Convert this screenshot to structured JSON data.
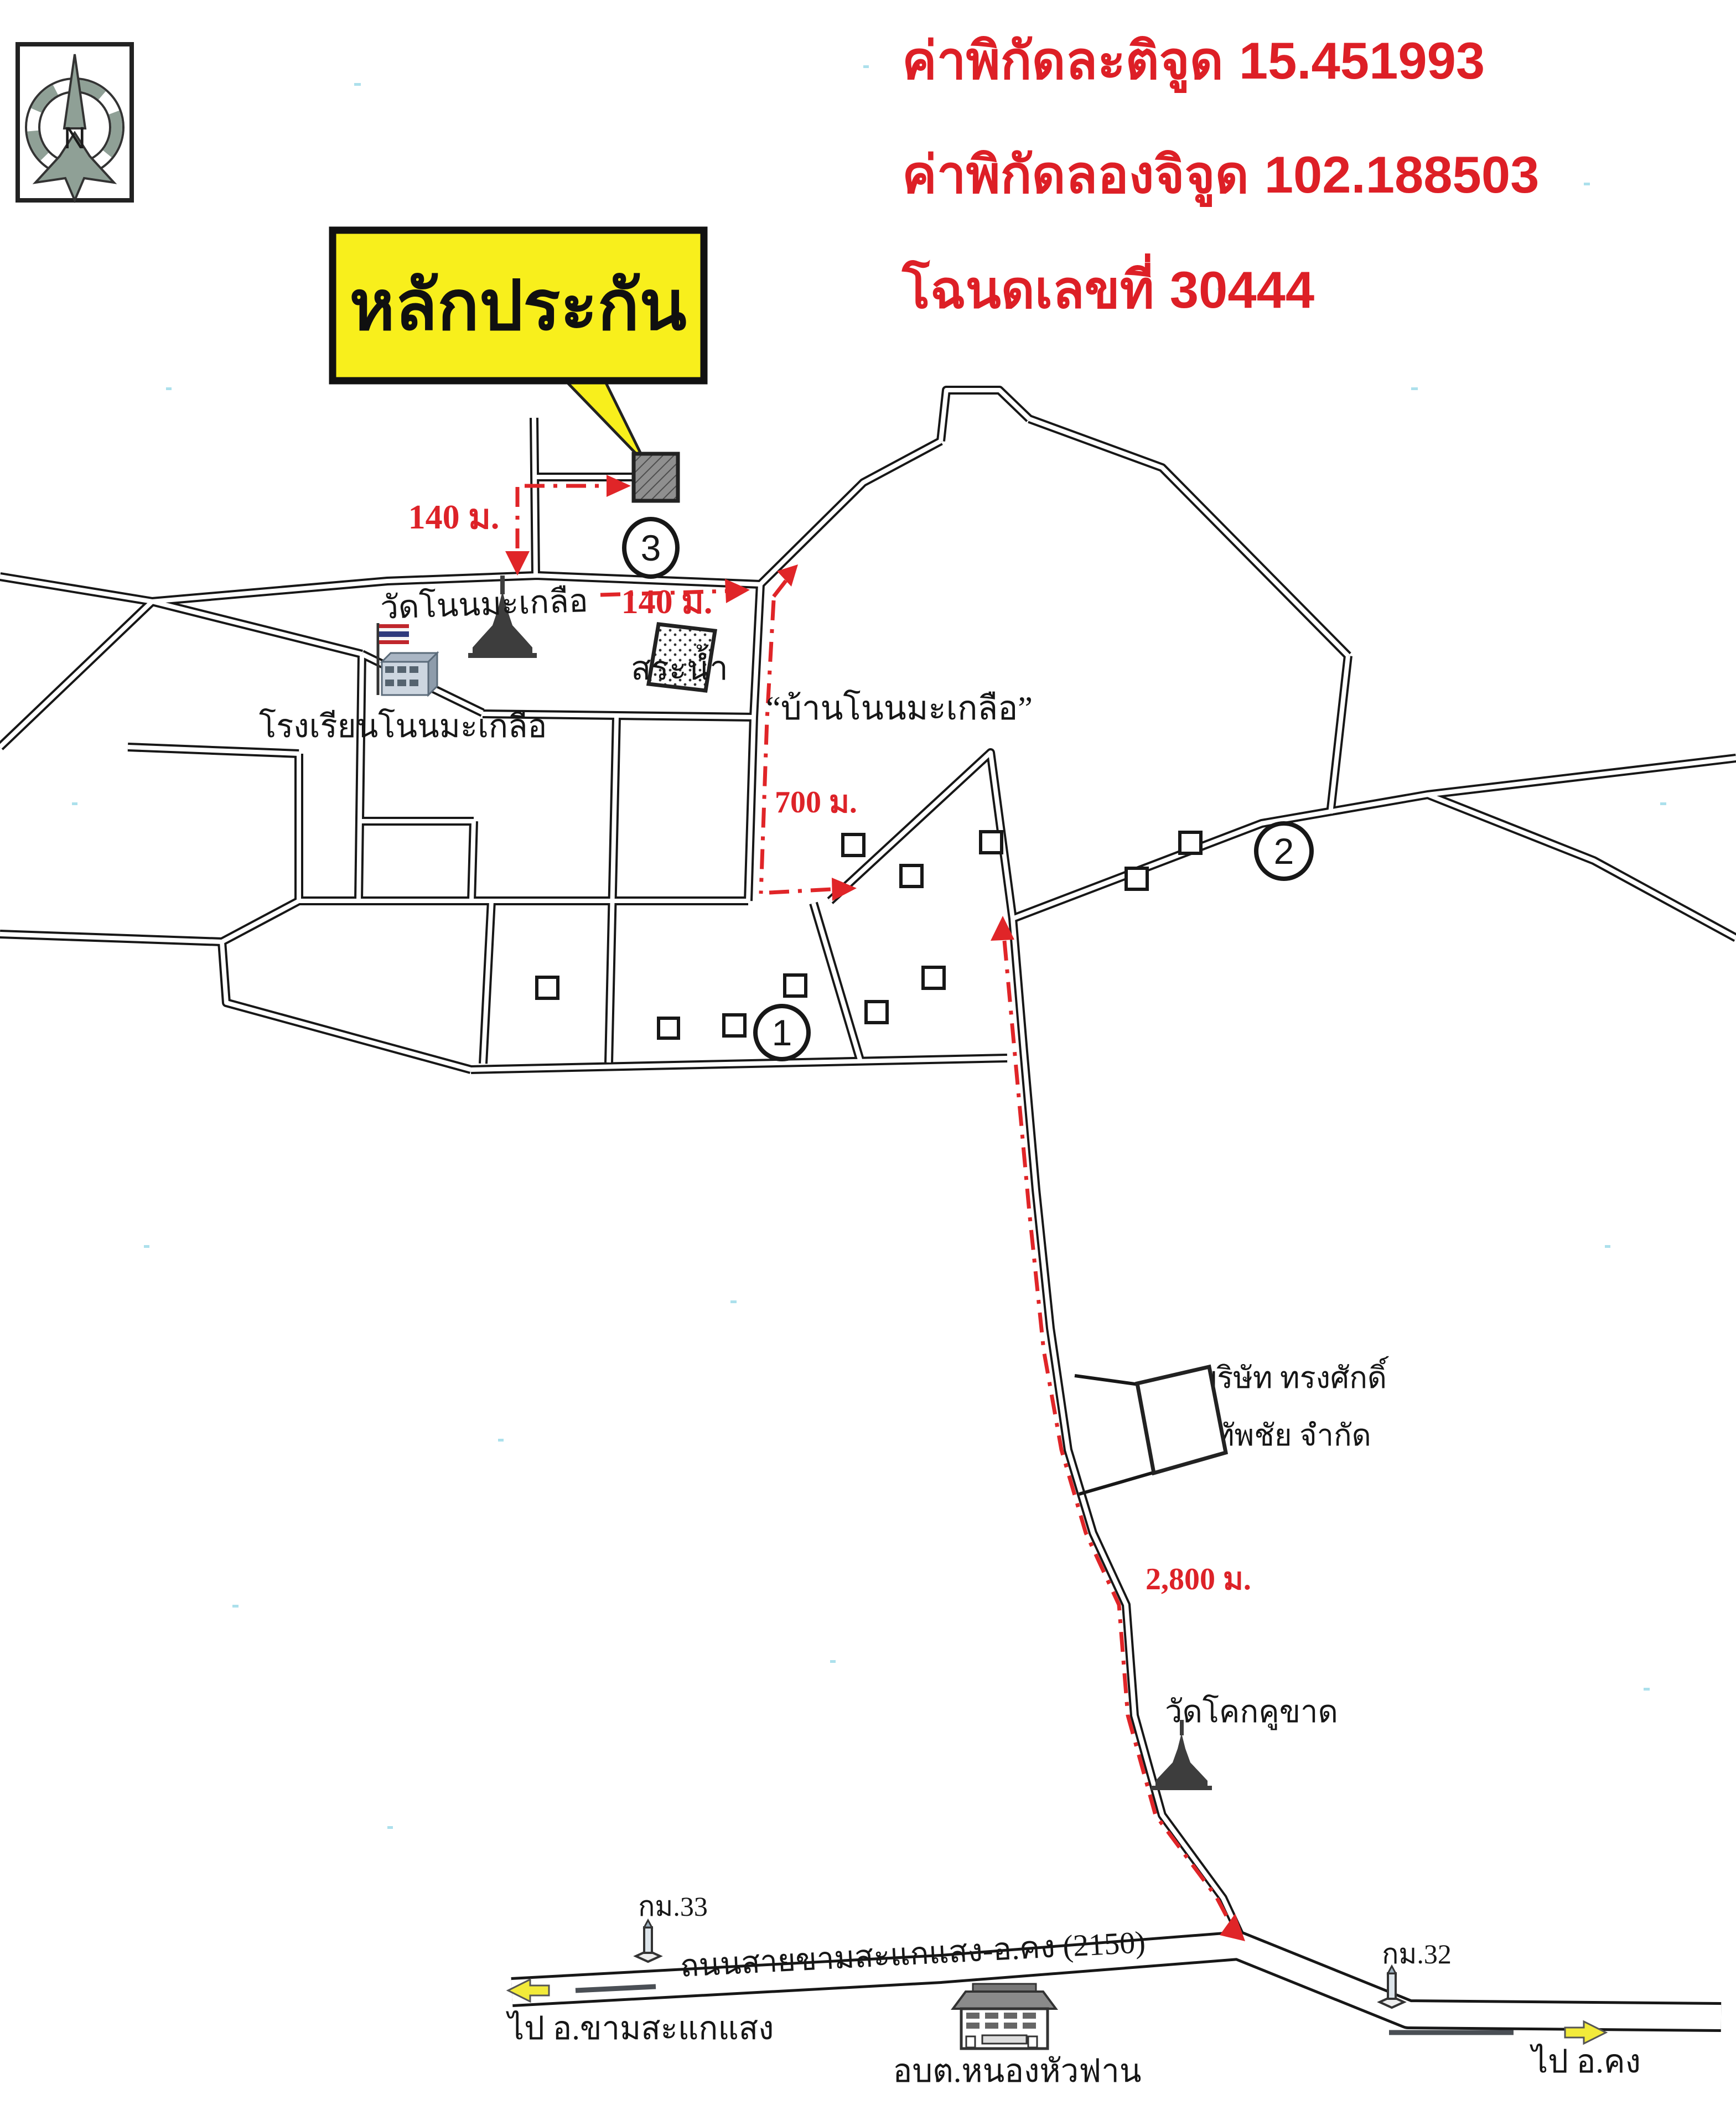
{
  "colors": {
    "header_red": "#dd1f26",
    "route_red": "#e02528",
    "sign_yellow": "#f8ef1c",
    "road_black": "#171717",
    "scan_speck_cyan": "#9edbe9",
    "property_gray": "#8f8f8f"
  },
  "header": {
    "coords": [
      {
        "label": "ค่าพิกัดละติจูด",
        "value": "15.451993"
      },
      {
        "label": "ค่าพิกัดลองจิจูด",
        "value": "102.188503"
      },
      {
        "label": "โฉนดเลขที่",
        "value": "30444"
      }
    ]
  },
  "collateral_sign": {
    "label": "หลักประกัน"
  },
  "compass": {
    "label": "N"
  },
  "map": {
    "landmarks": {
      "temple_main": "วัดโนนมะเกลือ",
      "pond": "สระน้ำ",
      "village": "“บ้านโนนมะเกลือ”",
      "school": "โรงเรียนโนนมะเกลือ",
      "company_line1": "บริษัท ทรงศักดิ์",
      "company_line2": "ทัพชัย จำกัด",
      "temple_south": "วัดโคกคูขาด",
      "subdistrict_office": "อบต.หนองหัวฟาน"
    },
    "route_distances": {
      "d1": "140 ม.",
      "d2": "140 ม.",
      "d3": "700 ม.",
      "d4": "2,800 ม."
    },
    "highway": {
      "name": "ถนนสายขามสะแกแสง-อ.คง (2150)",
      "km33": "กม.33",
      "km32": "กม.32",
      "to_west": "ไป อ.ขามสะแกแสง",
      "to_east": "ไป อ.คง"
    },
    "zone_markers": [
      "1",
      "2",
      "3"
    ]
  }
}
